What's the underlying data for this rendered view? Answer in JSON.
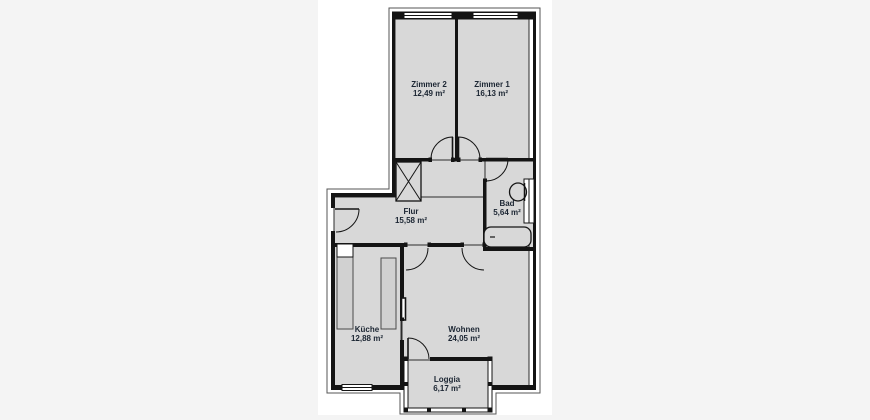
{
  "plan": {
    "type": "floor-plan",
    "rooms": {
      "zimmer2": {
        "name": "Zimmer 2",
        "area": "12,49 m²"
      },
      "zimmer1": {
        "name": "Zimmer 1",
        "area": "16,13 m²"
      },
      "flur": {
        "name": "Flur",
        "area": "15,58 m²"
      },
      "bad": {
        "name": "Bad",
        "area": "5,64 m²"
      },
      "kueche": {
        "name": "Küche",
        "area": "12,88 m²"
      },
      "wohnen": {
        "name": "Wohnen",
        "area": "24,05 m²"
      },
      "loggia": {
        "name": "Loggia",
        "area": "6,17 m²"
      }
    },
    "colors": {
      "page_margin": "#f4f4f4",
      "sheet": "#ffffff",
      "room_fill": "#d8d8d8",
      "wall": "#141414",
      "label_text": "#1c2633"
    }
  }
}
